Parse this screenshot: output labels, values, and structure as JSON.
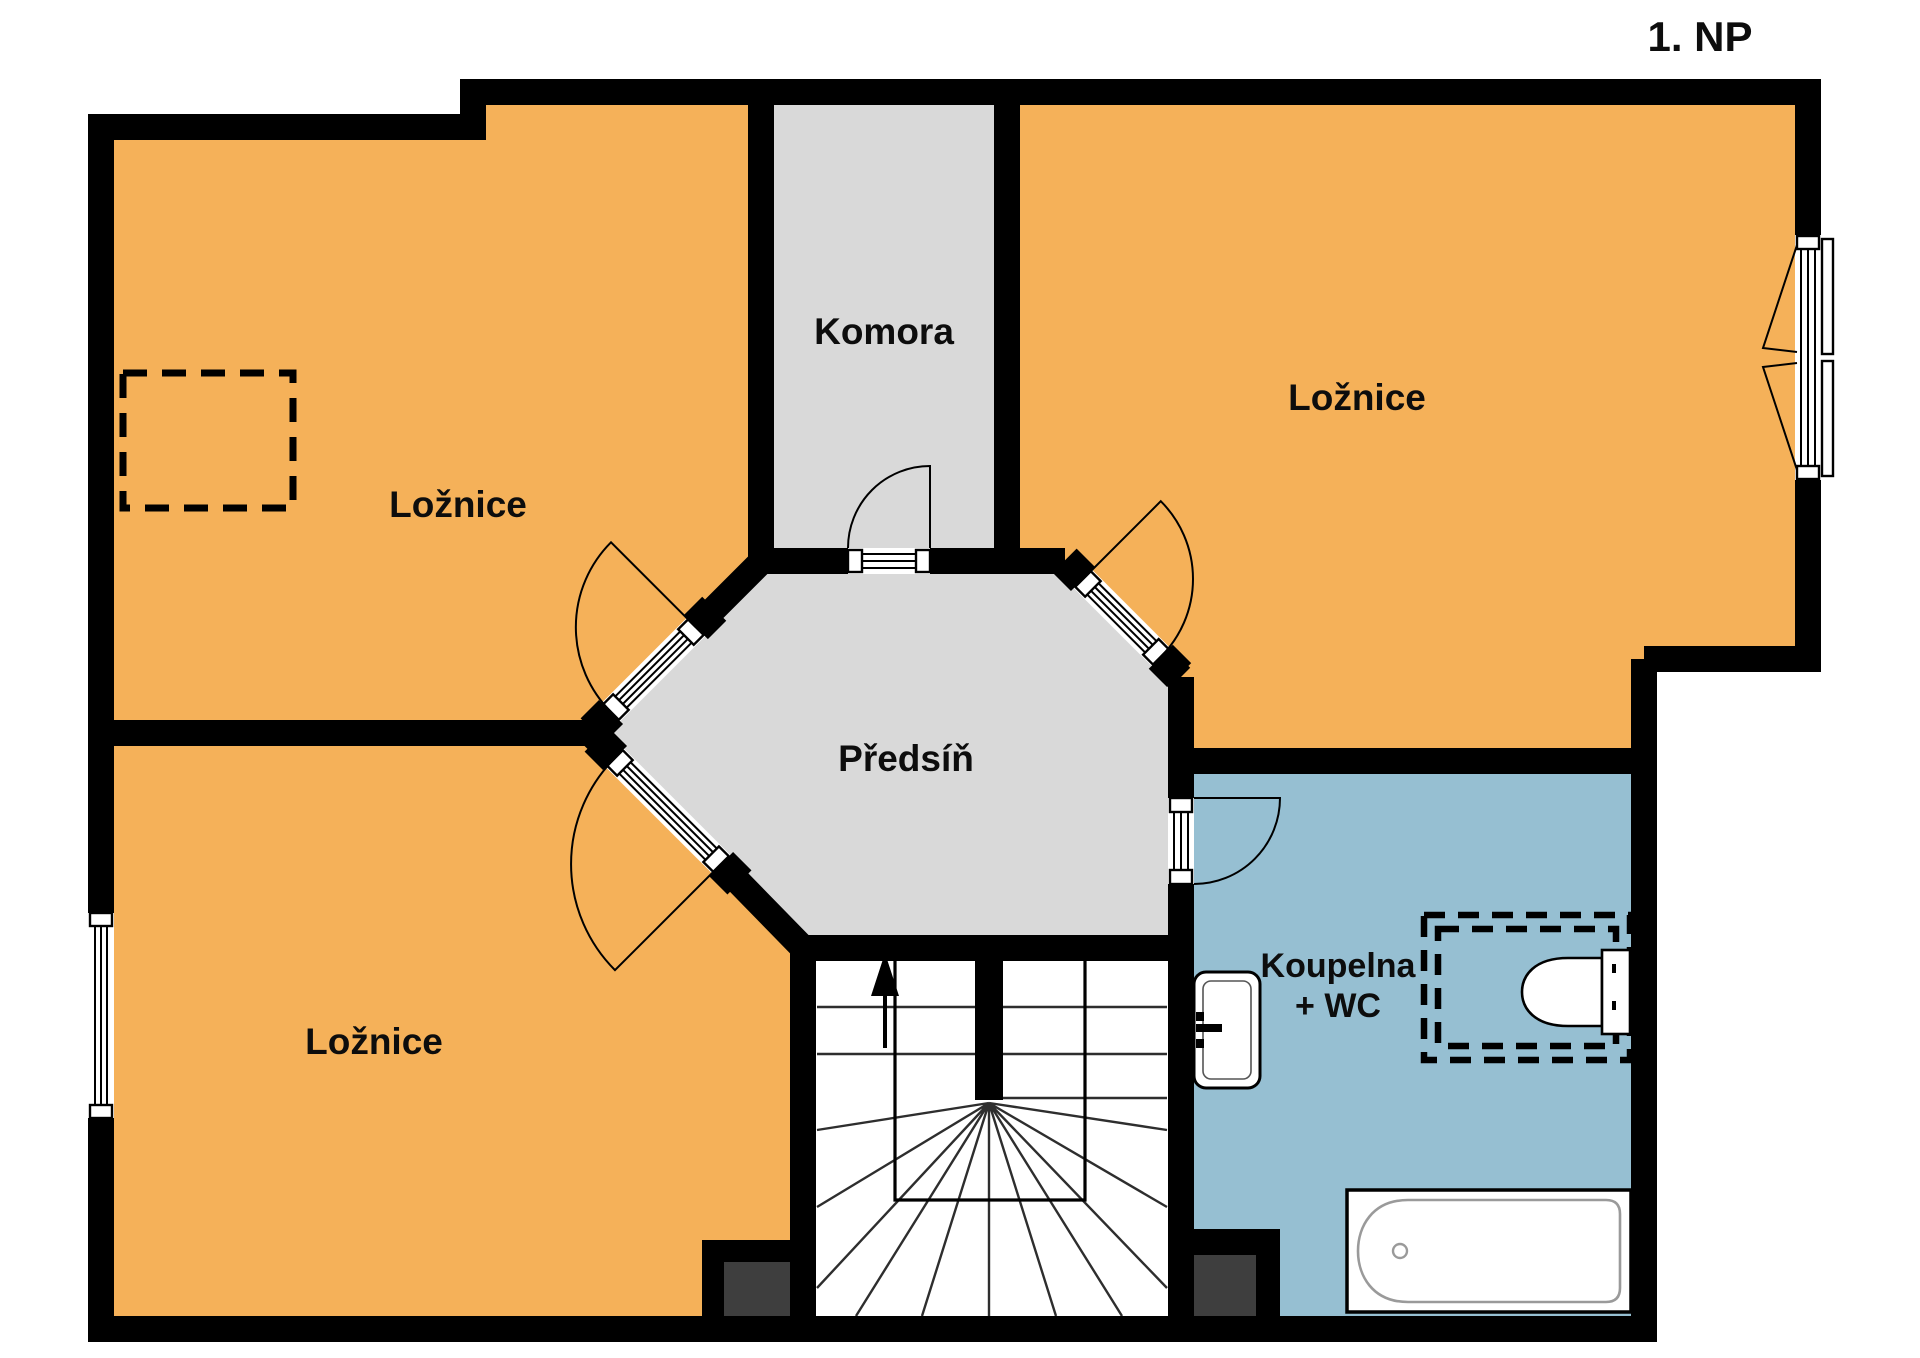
{
  "title": "1. NP",
  "colors": {
    "room_orange": "#F5B159",
    "room_gray": "#D9D9D9",
    "room_blue": "#96BFD2",
    "wall": "#000000",
    "chimney": "#3E3E3E",
    "floor_white": "#FFFFFF",
    "tub_line": "#9A9A9A"
  },
  "rooms": {
    "bedroom_top_left": {
      "label": "Ložnice"
    },
    "storage": {
      "label": "Komora"
    },
    "bedroom_top_right": {
      "label": "Ložnice"
    },
    "hallway": {
      "label": "Předsíň"
    },
    "bedroom_bottom_left": {
      "label": "Ložnice"
    },
    "bathroom": {
      "label_line1": "Koupelna",
      "label_line2": "+ WC"
    }
  }
}
